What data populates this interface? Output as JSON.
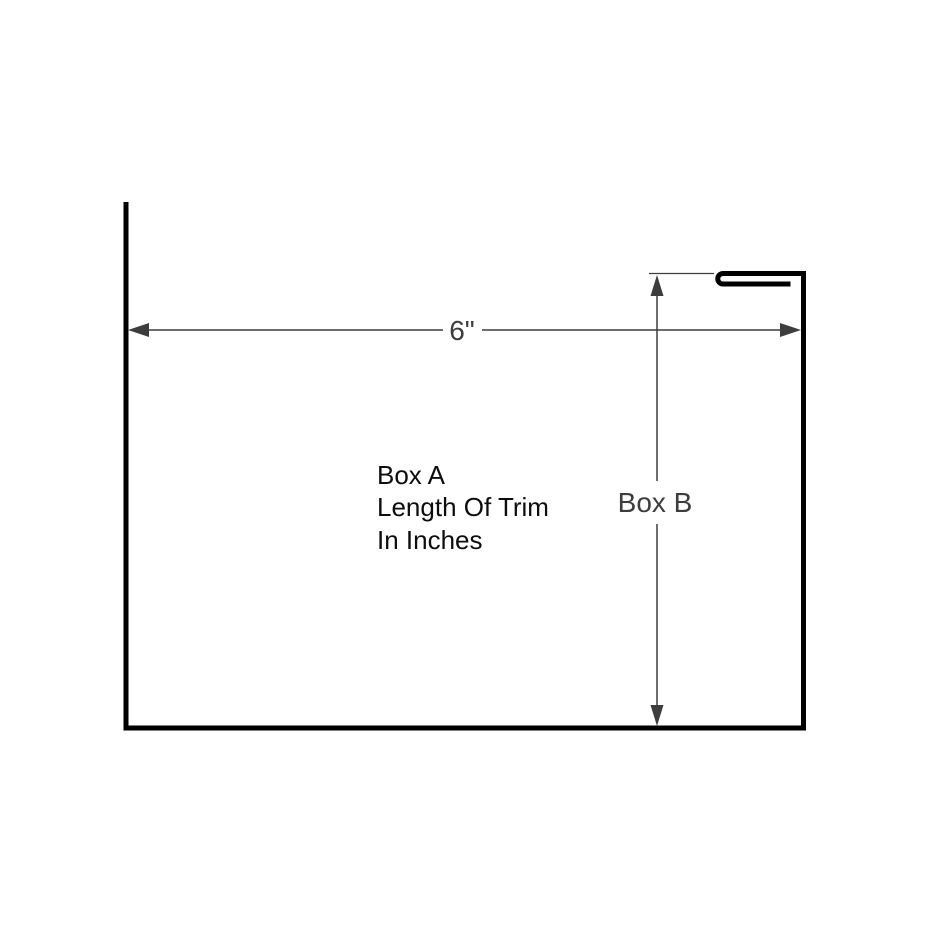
{
  "diagram": {
    "type": "technical-drawing-trim-profile",
    "background_color": "#ffffff",
    "profile_color": "#000000",
    "dimension_color": "#3d3d3d",
    "labels": {
      "horizontal_dimension": "6\"",
      "box_a_line1": "Box A",
      "box_a_line2": "Length Of Trim",
      "box_a_line3": "In Inches",
      "vertical_dimension": "Box B"
    }
  }
}
